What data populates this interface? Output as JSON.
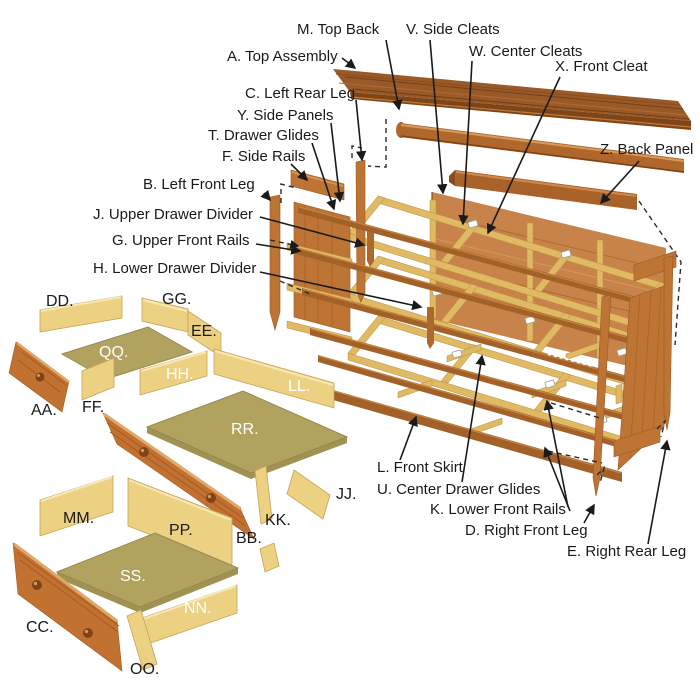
{
  "callouts": {
    "top_back": "M. Top Back",
    "side_cleats": "V. Side Cleats",
    "top_assembly": "A. Top Assembly",
    "center_cleats": "W. Center Cleats",
    "front_cleat": "X. Front Cleat",
    "left_rear_leg": "C. Left Rear Leg",
    "side_panels": "Y. Side Panels",
    "drawer_glides": "T. Drawer Glides",
    "side_rails": "F. Side Rails",
    "left_front_leg": "B. Left Front Leg",
    "upper_drawer_divider": "J. Upper Drawer Divider",
    "upper_front_rails": "G. Upper Front Rails",
    "lower_drawer_divider": "H. Lower Drawer Divider",
    "back_panel": "Z. Back Panel",
    "front_skirt": "L. Front Skirt",
    "center_drawer_glides": "U. Center Drawer Glides",
    "lower_front_rails": "K. Lower Front Rails",
    "right_front_leg": "D. Right Front Leg",
    "right_rear_leg": "E. Right Rear Leg"
  },
  "part_letters": {
    "dd": "DD.",
    "gg": "GG.",
    "ee": "EE.",
    "qq": "QQ.",
    "hh": "HH.",
    "ll": "LL.",
    "aa": "AA.",
    "ff": "FF.",
    "rr": "RR.",
    "jj": "JJ.",
    "mm": "MM.",
    "pp": "PP.",
    "bb": "BB.",
    "kk": "KK.",
    "ss": "SS.",
    "nn": "NN.",
    "cc": "CC.",
    "oo": "OO."
  },
  "colors": {
    "background": "#ffffff",
    "label_text": "#1a1a1a",
    "label_text_light": "#ffffff",
    "top_panel": "#9a5a28",
    "rail_brown": "#a3612a",
    "leg_and_panel_orange": "#bd7434",
    "back_panel_orange": "#c8834a",
    "web_frame_yellow": "#dfb964",
    "drawer_side_yellow": "#ecd183",
    "drawer_bottom_olive": "#b1a260",
    "drawer_front_orange": "#c17231",
    "knob_brown": "#7e4418"
  }
}
